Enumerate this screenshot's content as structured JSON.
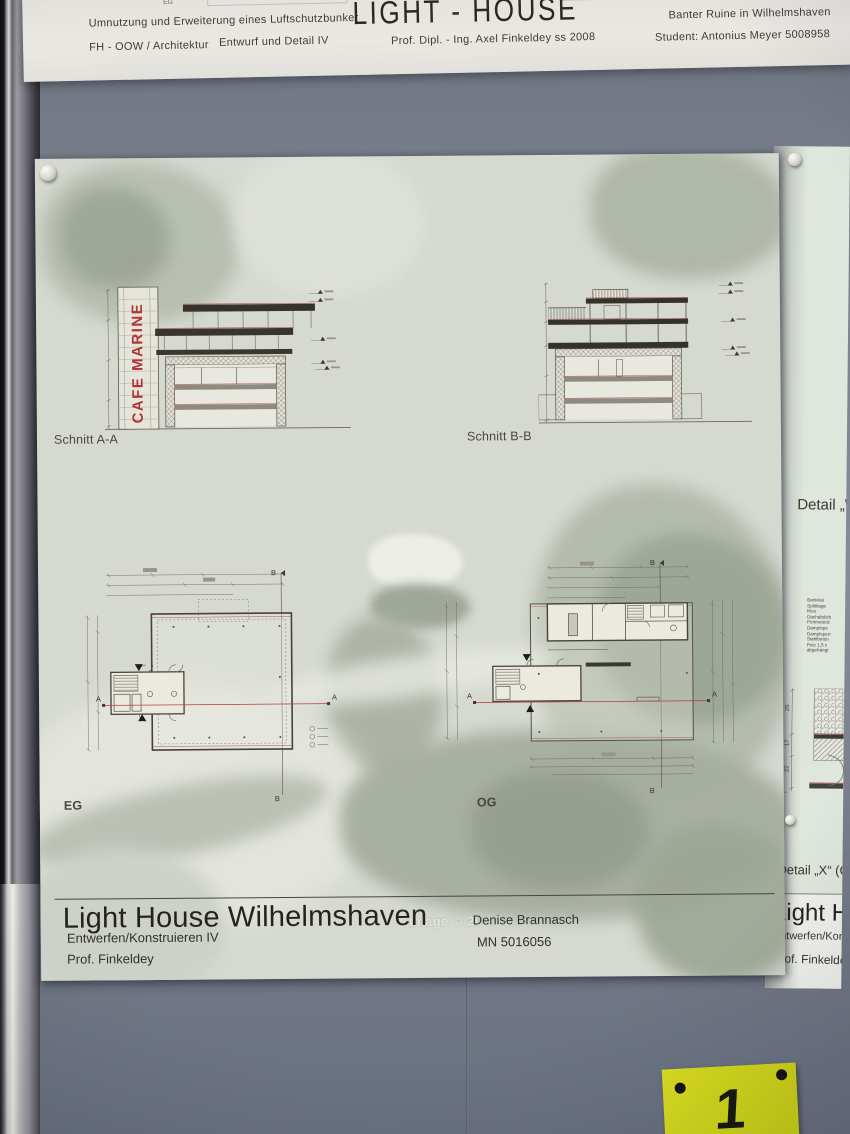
{
  "top_strip": {
    "floor_label_eg": "EG",
    "floor_label_og": "1. OG",
    "subtitle": "Umnutzung und Erweiterung eines Luftschutzbunker",
    "school": "FH - OOW / Architektur",
    "course": "Entwurf und Detail IV",
    "title": "LIGHT - HOUSE",
    "professor": "Prof. Dipl. - Ing. Axel Finkeldey  ss 2008",
    "site": "Banter Ruine in Wilhelmshaven",
    "student": "Student: Antonius Meyer 5008958"
  },
  "main_poster": {
    "cafe_sign": "CAFE MARINE",
    "section_a_label": "Schnitt A-A",
    "section_b_label": "Schnitt B-B",
    "plan_eg_label": "EG",
    "plan_og_label": "OG",
    "marker_a": "A",
    "marker_b": "B",
    "watermark": "Image © 20",
    "titleblock": {
      "title": "Light House Wilhelmshaven",
      "course": "Entwerfen/Konstruieren IV",
      "professor": "Prof. Finkeldey",
      "student_name": "Denise Brannasch",
      "student_id": "MN 5016056"
    }
  },
  "right_poster": {
    "detail_w_label": "Detail „W",
    "detail_x_label": "Detail „X“ (Gla",
    "spec_lines": [
      "Bankirai",
      "Splittlage",
      "Kies",
      "Dachabdich",
      "Perimeterd",
      "Dampfspe",
      "Dampfsperr",
      "Stahlbeton",
      "Putz 1,5 c",
      "abgehängt"
    ],
    "dim_values": [
      "25",
      "17",
      "22"
    ],
    "titleblock": {
      "title": "Light Ho",
      "course": "Entwerfen/Kons",
      "professor": "Prof. Finkeldey"
    }
  },
  "wall_tag": {
    "number": "1"
  },
  "colors": {
    "wall": "#767d89",
    "poster_paper": "#d5d9d0",
    "right_poster_paper": "#dfe6dc",
    "header_paper": "#e8e6e1",
    "accent_red": "#b23530",
    "drawing_ink": "#44403a",
    "tag_yellow": "#d5da1c"
  }
}
